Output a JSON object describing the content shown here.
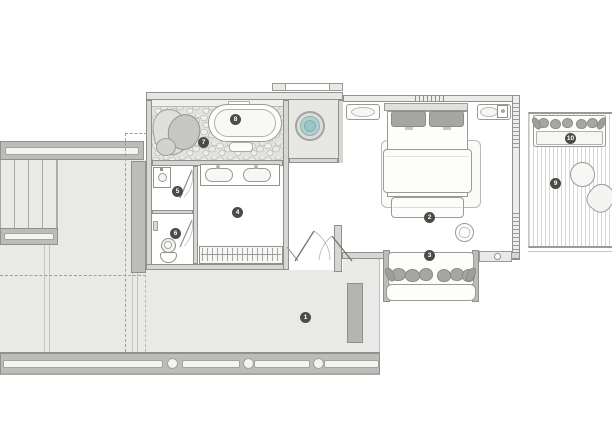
{
  "plan": {
    "type": "architectural-floor-plan",
    "badges": [
      {
        "label": "1"
      },
      {
        "label": "2"
      },
      {
        "label": "3"
      },
      {
        "label": "4"
      },
      {
        "label": "5"
      },
      {
        "label": "6"
      },
      {
        "label": "7"
      },
      {
        "label": "8"
      },
      {
        "label": "9"
      },
      {
        "label": "10"
      }
    ],
    "colors": {
      "floor_gray": "#e9e9e7",
      "wall_gray": "#bcbcb9",
      "line_gray": "#9a9a97",
      "accent_teal": "#9cc5c4",
      "cushion_gray": "#a6a6a3",
      "badge_dark": "#4b4b48"
    }
  }
}
